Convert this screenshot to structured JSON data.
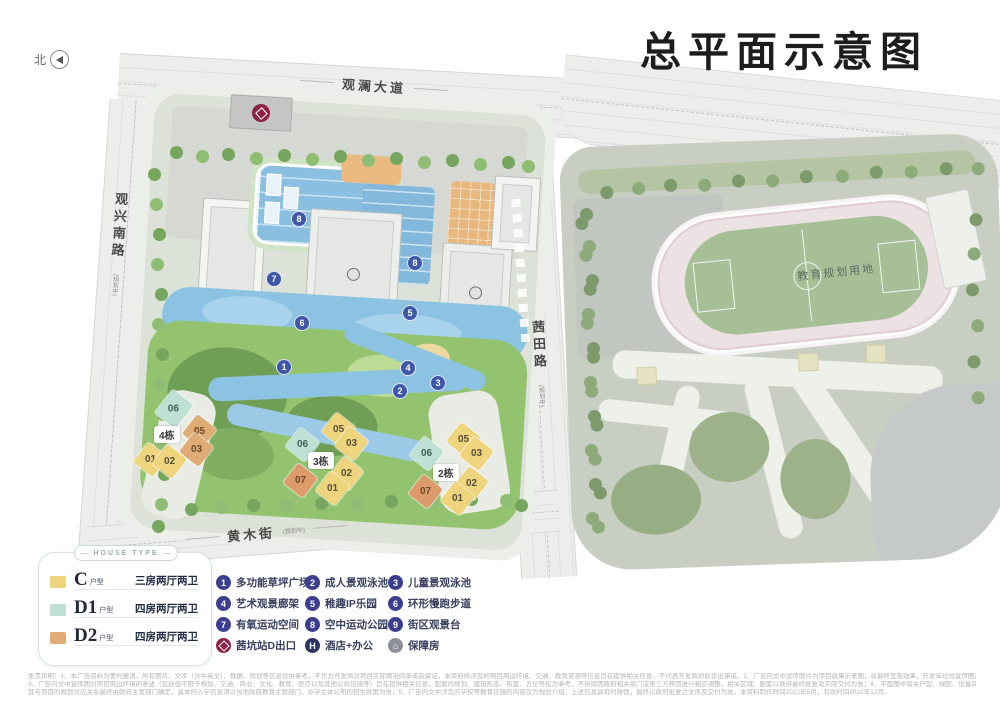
{
  "title": "总平面示意图",
  "north": {
    "label": "北"
  },
  "roads": {
    "top": {
      "name": "观澜大道"
    },
    "left": {
      "name": "观兴南路",
      "note": "(规划中)"
    },
    "right": {
      "name": "茜田路",
      "note": "(规划中)"
    },
    "bottom": {
      "name": "黄木街",
      "note": "(规划中)"
    }
  },
  "map": {
    "education_label": "教育规划用地",
    "clusters": [
      {
        "name": "4栋",
        "units": [
          {
            "no": "06",
            "type": "D1"
          },
          {
            "no": "05",
            "type": "D2"
          },
          {
            "no": "03",
            "type": "D2"
          },
          {
            "no": "01",
            "type": "C"
          },
          {
            "no": "02",
            "type": "C"
          }
        ]
      },
      {
        "name": "3栋",
        "units": [
          {
            "no": "05",
            "type": "C"
          },
          {
            "no": "03",
            "type": "C"
          },
          {
            "no": "06",
            "type": "D1"
          },
          {
            "no": "07",
            "type": "D2"
          },
          {
            "no": "02",
            "type": "C"
          },
          {
            "no": "01",
            "type": "C"
          }
        ]
      },
      {
        "name": "2栋",
        "units": [
          {
            "no": "05",
            "type": "C"
          },
          {
            "no": "03",
            "type": "C"
          },
          {
            "no": "06",
            "type": "D1"
          },
          {
            "no": "07",
            "type": "D2"
          },
          {
            "no": "02",
            "type": "C"
          },
          {
            "no": "01",
            "type": "C"
          }
        ]
      }
    ],
    "markers": [
      {
        "n": "8"
      },
      {
        "n": "8"
      },
      {
        "n": "7"
      },
      {
        "n": "6"
      },
      {
        "n": "5"
      },
      {
        "n": "1"
      },
      {
        "n": "4"
      },
      {
        "n": "2"
      },
      {
        "n": "3"
      }
    ]
  },
  "legend": {
    "header": "HOUSE TYPE",
    "house_types": [
      {
        "code": "C",
        "suffix": "户型",
        "desc": "三房两厅两卫",
        "color": "#eed47d"
      },
      {
        "code": "D1",
        "suffix": "户型",
        "desc": "四房两厅两卫",
        "color": "#bfe0d4"
      },
      {
        "code": "D2",
        "suffix": "户型",
        "desc": "四房两厅两卫",
        "color": "#dfac76"
      }
    ],
    "amenities": [
      {
        "num": "1",
        "label": "多功能草坪广场"
      },
      {
        "num": "2",
        "label": "成人景观泳池"
      },
      {
        "num": "3",
        "label": "儿童景观泳池"
      },
      {
        "num": "4",
        "label": "艺术观景廊架"
      },
      {
        "num": "5",
        "label": "稚趣IP乐园"
      },
      {
        "num": "6",
        "label": "环形慢跑步道"
      },
      {
        "num": "7",
        "label": "有氧运动空间"
      },
      {
        "num": "8",
        "label": "空中运动公园"
      },
      {
        "num": "9",
        "label": "街区观景台"
      },
      {
        "icon": "metro",
        "label": "茜坑站D出口"
      },
      {
        "icon": "hotel",
        "label": "酒店+办公"
      },
      {
        "icon": "housing",
        "label": "保障房"
      }
    ]
  },
  "colors": {
    "marker_blue": "#3e57a9",
    "legend_circle": "#3c3f90",
    "metro_red": "#8e2244",
    "type_c": "#eed47d",
    "type_d1": "#bfe0d4",
    "type_d2": "#dfac76"
  },
  "disclaimer": {
    "l1": "免责声明：1、本广告资料为要约邀请，所有图片、文字（含中英文）、数据、规划等信息仅供参考，不作为开发商对项目实际情况的承诺及保证，本资料所涉及的项目周边环境、交通、教育资源等信息旨在提供相关信息，不代表开发商对此作出承诺。2、广告内文中宣传图片为项目效果示意图，非最终呈现效果，开发单位对宣传图片涉及的建筑体量、建筑立面、造型等工艺保留调整权利。",
    "l2": "3、广告内文中宣传图对项目周边环境的表述（包括但不限于规划、交通、商业、文化、教育、医疗以及其他公共设施等）旨在提供相关信息，配套的规划、建筑形态、布置、方位等仅为参考，不排除因政府相关部门或第三方原因进行相应调整，相关区域、配套以政府最终批复及实际交付为准；4、平面图中有关户型、绿配、设备间、管道、空调外机位等以实际交付为准。",
    "l3": "其与项目的规划对应关系最终由政府主管部门确定，具体的入学信息须以当地政府教育主管部门、办学主体公布的招生政策为准；5、广告内文中涉及的学校等教育设施的内容仅为规划介绍，上述信息具有时效性，最终以政府批复之文件及交付为准。本资料制作时间2022年5月，有效时间2022年12月。"
  }
}
